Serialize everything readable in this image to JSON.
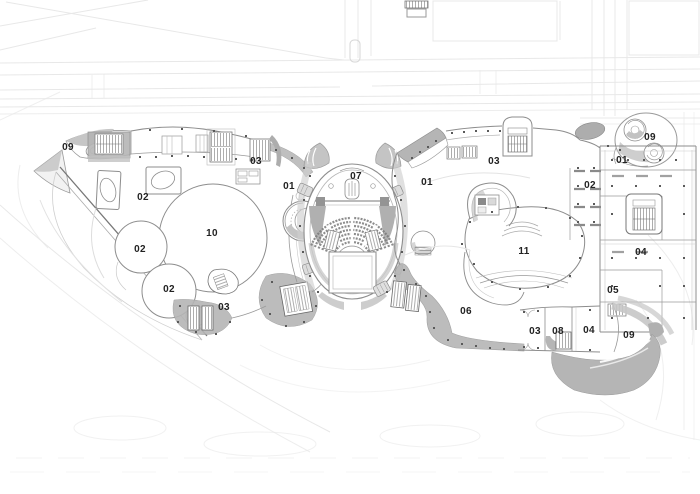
{
  "plan": {
    "type": "architectural-site-plan",
    "labels": [
      {
        "text": "09",
        "x": 68,
        "y": 148
      },
      {
        "text": "02",
        "x": 143,
        "y": 198
      },
      {
        "text": "03",
        "x": 256,
        "y": 162
      },
      {
        "text": "01",
        "x": 289,
        "y": 187
      },
      {
        "text": "10",
        "x": 212,
        "y": 234
      },
      {
        "text": "02",
        "x": 140,
        "y": 250
      },
      {
        "text": "02",
        "x": 169,
        "y": 290
      },
      {
        "text": "03",
        "x": 224,
        "y": 308
      },
      {
        "text": "07",
        "x": 356,
        "y": 177
      },
      {
        "text": "01",
        "x": 427,
        "y": 183
      },
      {
        "text": "03",
        "x": 494,
        "y": 162
      },
      {
        "text": "11",
        "x": 524,
        "y": 252
      },
      {
        "text": "06",
        "x": 466,
        "y": 312
      },
      {
        "text": "03",
        "x": 535,
        "y": 332
      },
      {
        "text": "08",
        "x": 558,
        "y": 332
      },
      {
        "text": "04",
        "x": 589,
        "y": 331
      },
      {
        "text": "09",
        "x": 629,
        "y": 336
      },
      {
        "text": "05",
        "x": 613,
        "y": 291
      },
      {
        "text": "04",
        "x": 641,
        "y": 253
      },
      {
        "text": "02",
        "x": 590,
        "y": 186
      },
      {
        "text": "01",
        "x": 622,
        "y": 161
      },
      {
        "text": "09",
        "x": 650,
        "y": 138
      }
    ],
    "colors": {
      "paper": "#ffffff",
      "context_line": "#e8e8e8",
      "wall": "#8d8d8d",
      "wall_dark": "#6a6a6a",
      "zone_gray": "#b5b5b5",
      "label": "#222222"
    }
  }
}
